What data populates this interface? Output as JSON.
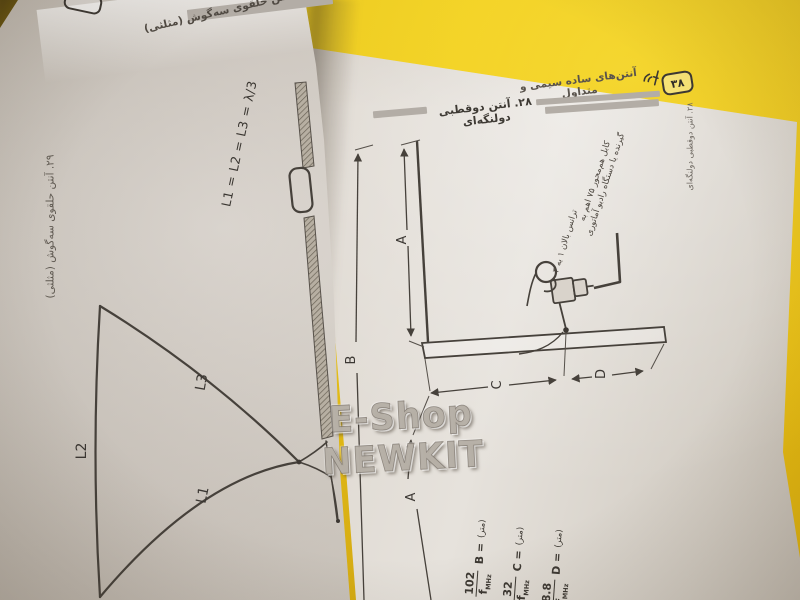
{
  "watermark": "E-Shop NEWKIT",
  "left_page": {
    "section_heading": "۲۹. آنتن حلقوی سه‌گوش (مثلثی)",
    "side_tab": "۲۹. آنتن حلقوی سه‌گوش (مثلثی)",
    "equation": "L1 = L2 = L3 = λ/3",
    "labels": {
      "l1": "L1",
      "l2": "L2",
      "l3": "L3"
    }
  },
  "right_page": {
    "running_header": "آنتن‌های ساده سیمی و متداول",
    "page_badge": "۳۸",
    "section_heading": "۲۸. آنتن دوقطبی دولنگه‌ای",
    "side_tab": "۲۸. آنتن دوقطبی دولنگه‌ای",
    "annotations": {
      "coax_line1": "کابل هم‌محور ۷۵ اهم به",
      "coax_line2": "گیرنده یا دستگاه رادیو آماتوری",
      "balun": "ترانس بالان ۱ به ۴"
    },
    "dims": {
      "a_upper": "A",
      "b": "B",
      "c": "C",
      "d": "D",
      "a_lower": "A"
    },
    "formulas": [
      {
        "unit": "(متر)",
        "lhs": "B =",
        "num": "102",
        "den": "f",
        "sub": "MHz"
      },
      {
        "unit": "(متر)",
        "lhs": "C =",
        "num": "32",
        "den": "f",
        "sub": "MHz"
      },
      {
        "unit": "(متر)",
        "lhs": "D =",
        "num": "8.8",
        "den": "f",
        "sub": "MHz"
      }
    ]
  },
  "colors": {
    "background_yellow": "#efca18",
    "paper": "#d6d0c8",
    "ink": "#45403a",
    "gray_bar": "#b3ada6"
  }
}
